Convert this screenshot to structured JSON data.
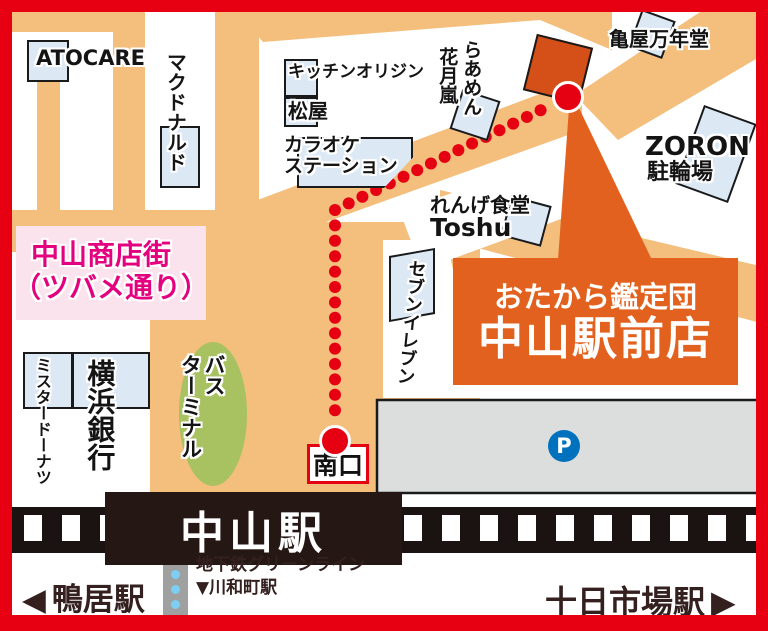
{
  "colors": {
    "frame_red": "#E60012",
    "road_orange": "#F4BE7C",
    "route_red": "#E50012",
    "building_blue": "#DCE9F5",
    "destination_orange": "#D54F18",
    "callout_orange": "#E2611E",
    "shotengai_pink_bg": "#FBE3EE",
    "shotengai_magenta": "#E3017F",
    "bus_terminal_green": "#A8C161",
    "station_dark": "#251714",
    "platform_gray": "#DCDDDD",
    "parking_blue": "#0071BC",
    "subway_dot_blue": "#7ECEF4"
  },
  "places": {
    "atocare": "ATOCARE",
    "mcdonalds": "マクドナルド",
    "kitchen_origin": "キッチンオリジン",
    "matsuya": "松屋",
    "karaoke_line1": "カラオケ",
    "karaoke_line2": "ステーション",
    "ramen_col1": "らあめん",
    "ramen_col2": "花月嵐",
    "kameya": "亀屋万年堂",
    "zoron_line1": "ZORON",
    "zoron_line2": "駐輪場",
    "renge_line1": "れんげ食堂",
    "renge_line2": "Toshu",
    "seven_eleven": "セブンイレブン",
    "shotengai_line1": "中山商店街",
    "shotengai_line2": "（ツバメ通り）",
    "mister_donut": "ミスタードーナツ",
    "yokohama_bank": "横浜銀行",
    "bus_terminal_line1": "バス",
    "bus_terminal_line2": "ターミナル",
    "south_exit": "南口",
    "parking": "P",
    "station": "中山駅"
  },
  "callout": {
    "line1": "おたから鑑定団",
    "line2": "中山駅前店"
  },
  "footer": {
    "left_arrow": "◀",
    "left_station": "鴨居駅",
    "right_station": "十日市場駅",
    "right_arrow": "▶",
    "subway_line1": "地下鉄グリーンライン",
    "subway_line2": "▼川和町駅"
  },
  "route": {
    "color": "#E50012",
    "dot_radius": 6,
    "dot_spacing": 15,
    "points": [
      {
        "x": 568,
        "y": 97
      },
      {
        "x": 335,
        "y": 210
      },
      {
        "x": 335,
        "y": 441
      }
    ]
  }
}
